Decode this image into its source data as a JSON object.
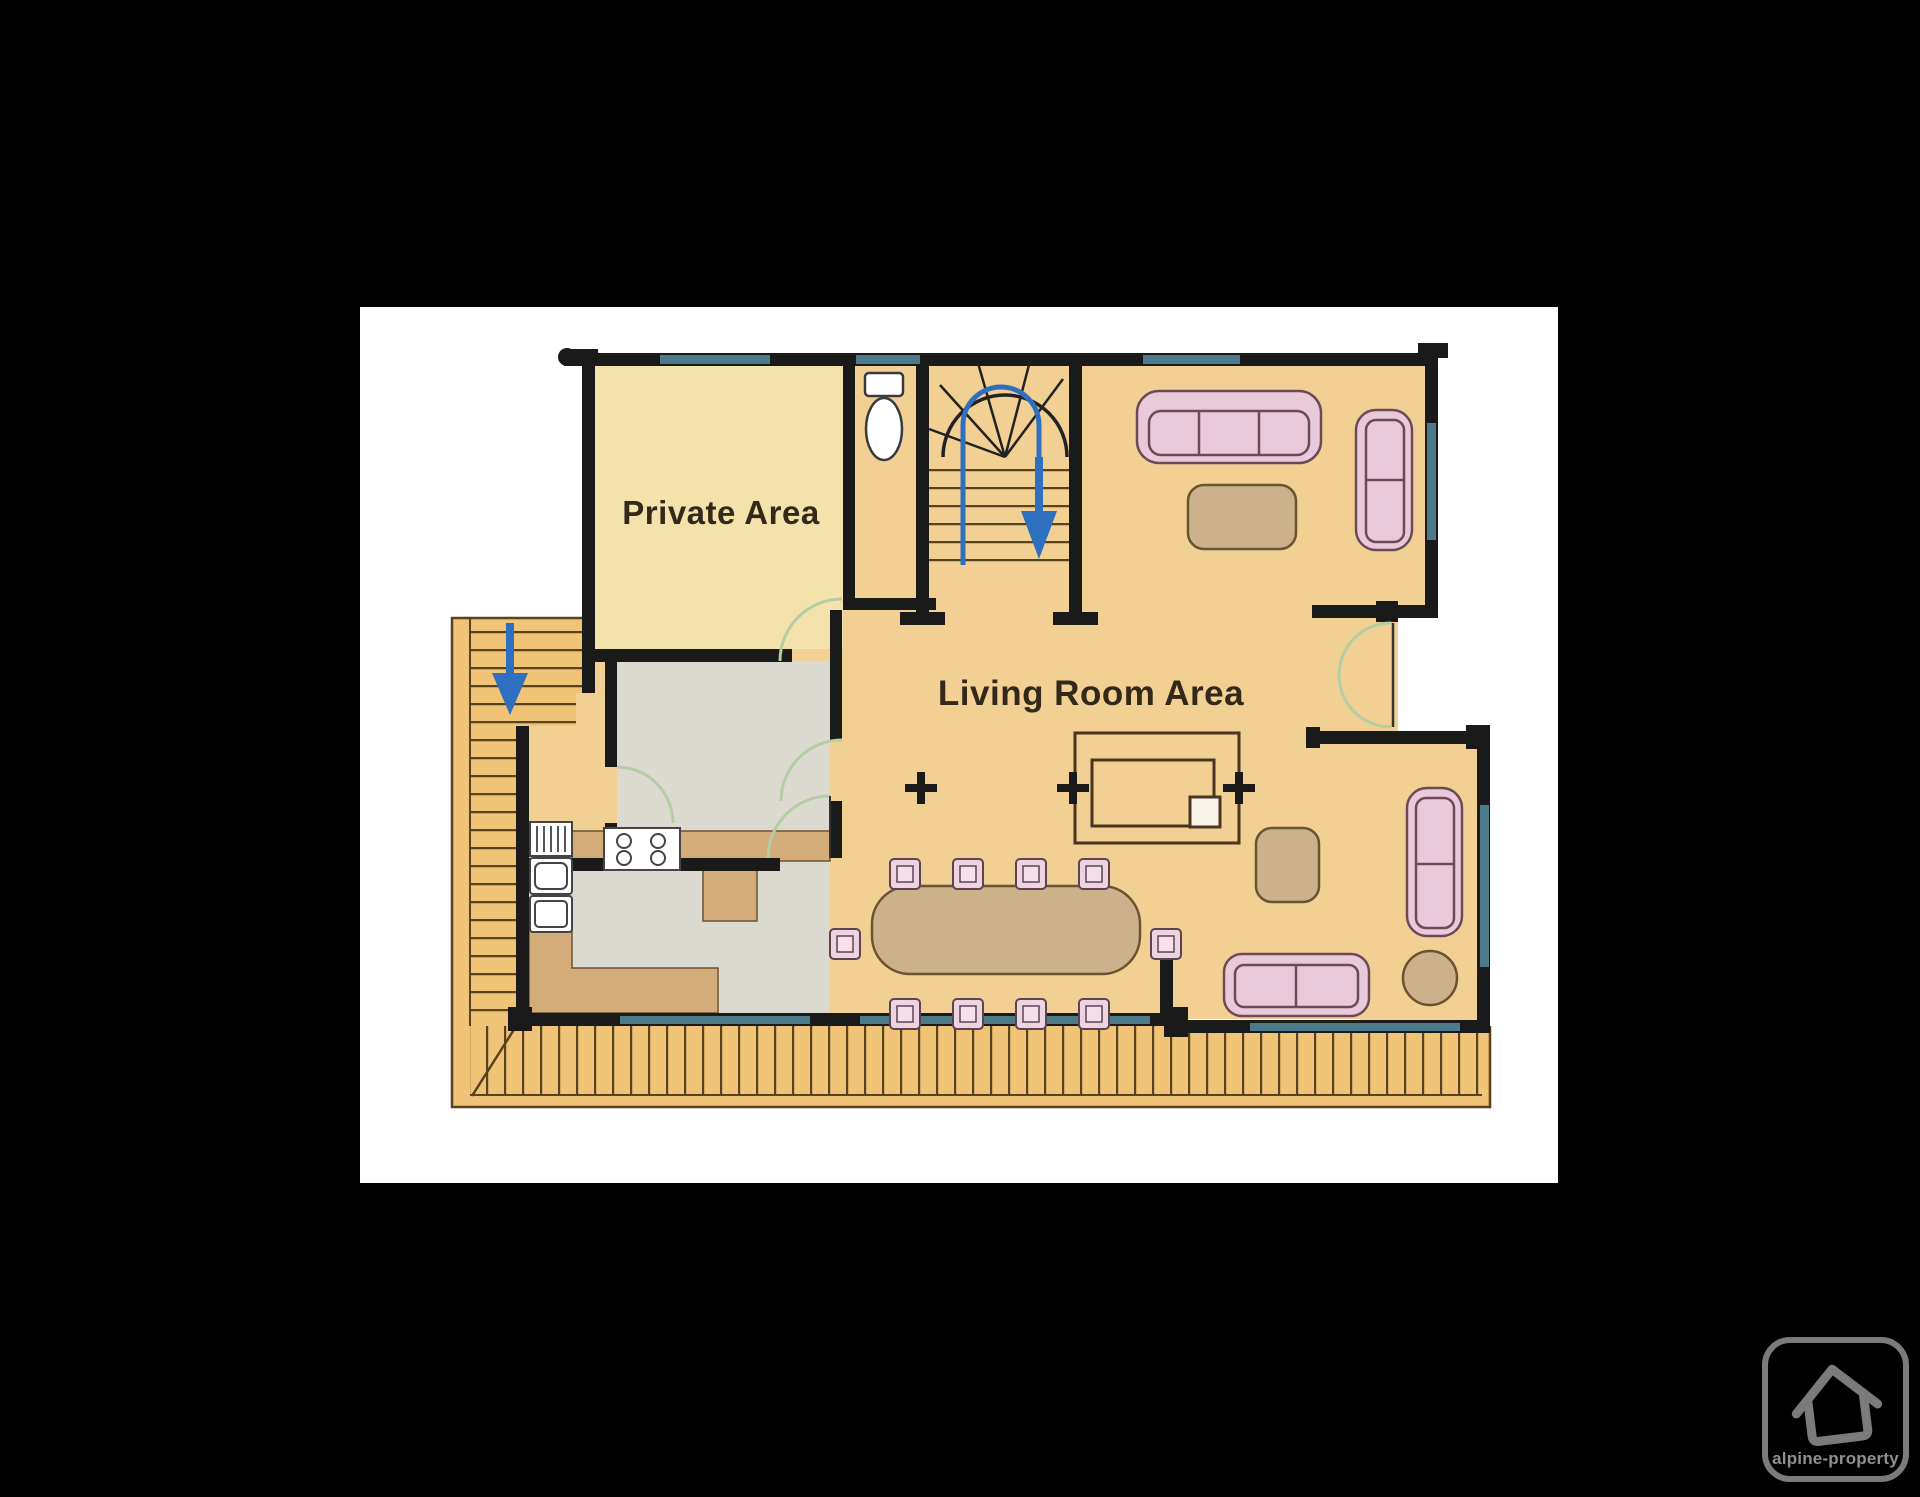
{
  "labels": {
    "private_area": "Private Area",
    "living_room": "Living Room Area"
  },
  "logo": {
    "text": "alpine-property"
  },
  "icons": [
    "stairs-down-arrow-icon",
    "house-logo-icon",
    "toilet-icon",
    "stove-icon",
    "column-marker-icon"
  ],
  "colors": {
    "bg": "#000000",
    "panel": "#ffffff",
    "wall": "#1a1a1a",
    "floor": "#f2cf92",
    "cream": "#f3e2ab",
    "deck": "#f0c376",
    "deckline": "#57431f",
    "gray": "#dcd9d1",
    "counter": "#d3ac79",
    "sofa": "#e9cada",
    "sofaline": "#6e4a58",
    "table": "#cbb28b",
    "tableline": "#6b5331",
    "chair": "#ecd4e0",
    "chairline": "#5d4452",
    "window": "#4d7a88",
    "door": "#b5cda2",
    "arrow": "#2e6fc0",
    "text": "#33291a",
    "logo": "#7b7b7b",
    "logotext": "#8f8f8f"
  }
}
